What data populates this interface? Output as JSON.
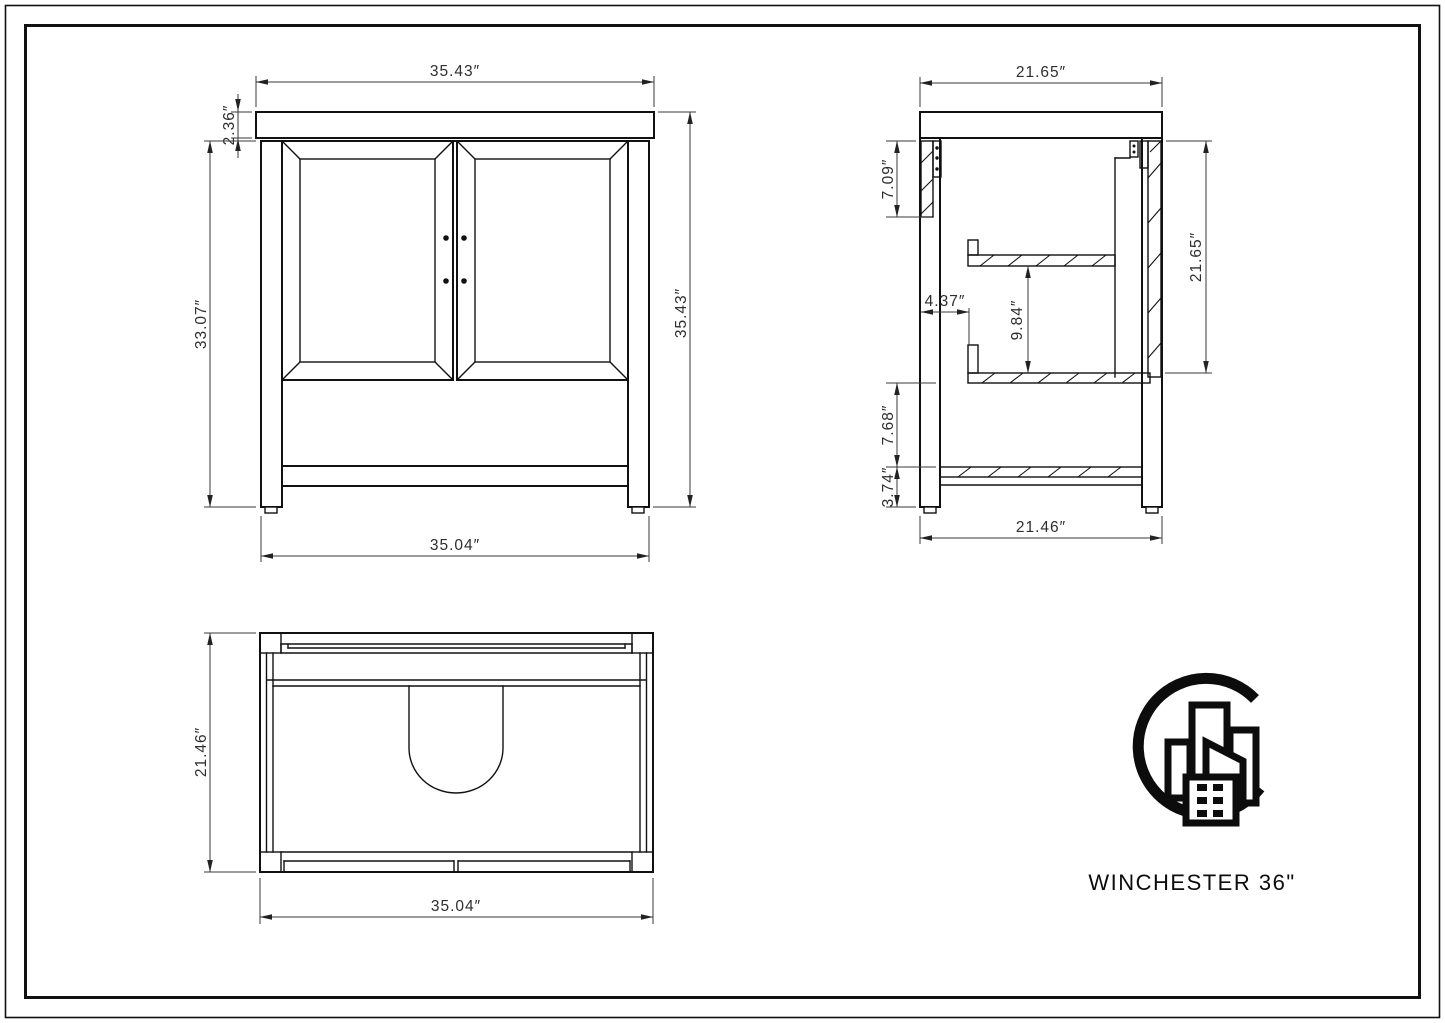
{
  "sheet": {
    "background": "#ffffff",
    "object_line_color": "#111111",
    "dimension_line_color": "#3a3a3a",
    "text_color": "#2e2e2e"
  },
  "front_view": {
    "top_width": "35.43″",
    "counter_thickness": "2.36″",
    "cabinet_height": "33.07″",
    "overall_height": "35.43″",
    "base_width": "35.04″"
  },
  "side_view": {
    "top_depth": "21.65″",
    "frame_height": "7.09″",
    "shelf_setback": "4.37″",
    "shelf_clearance": "9.84″",
    "interior_height": "21.65″",
    "lower_clearance": "7.68″",
    "base_height": "3.74″",
    "base_depth": "21.46″"
  },
  "top_view": {
    "depth": "21.46″",
    "width": "35.04″"
  },
  "branding": {
    "product_name": "WINCHESTER 36\"",
    "logo": "city-buildings-c-logo"
  }
}
